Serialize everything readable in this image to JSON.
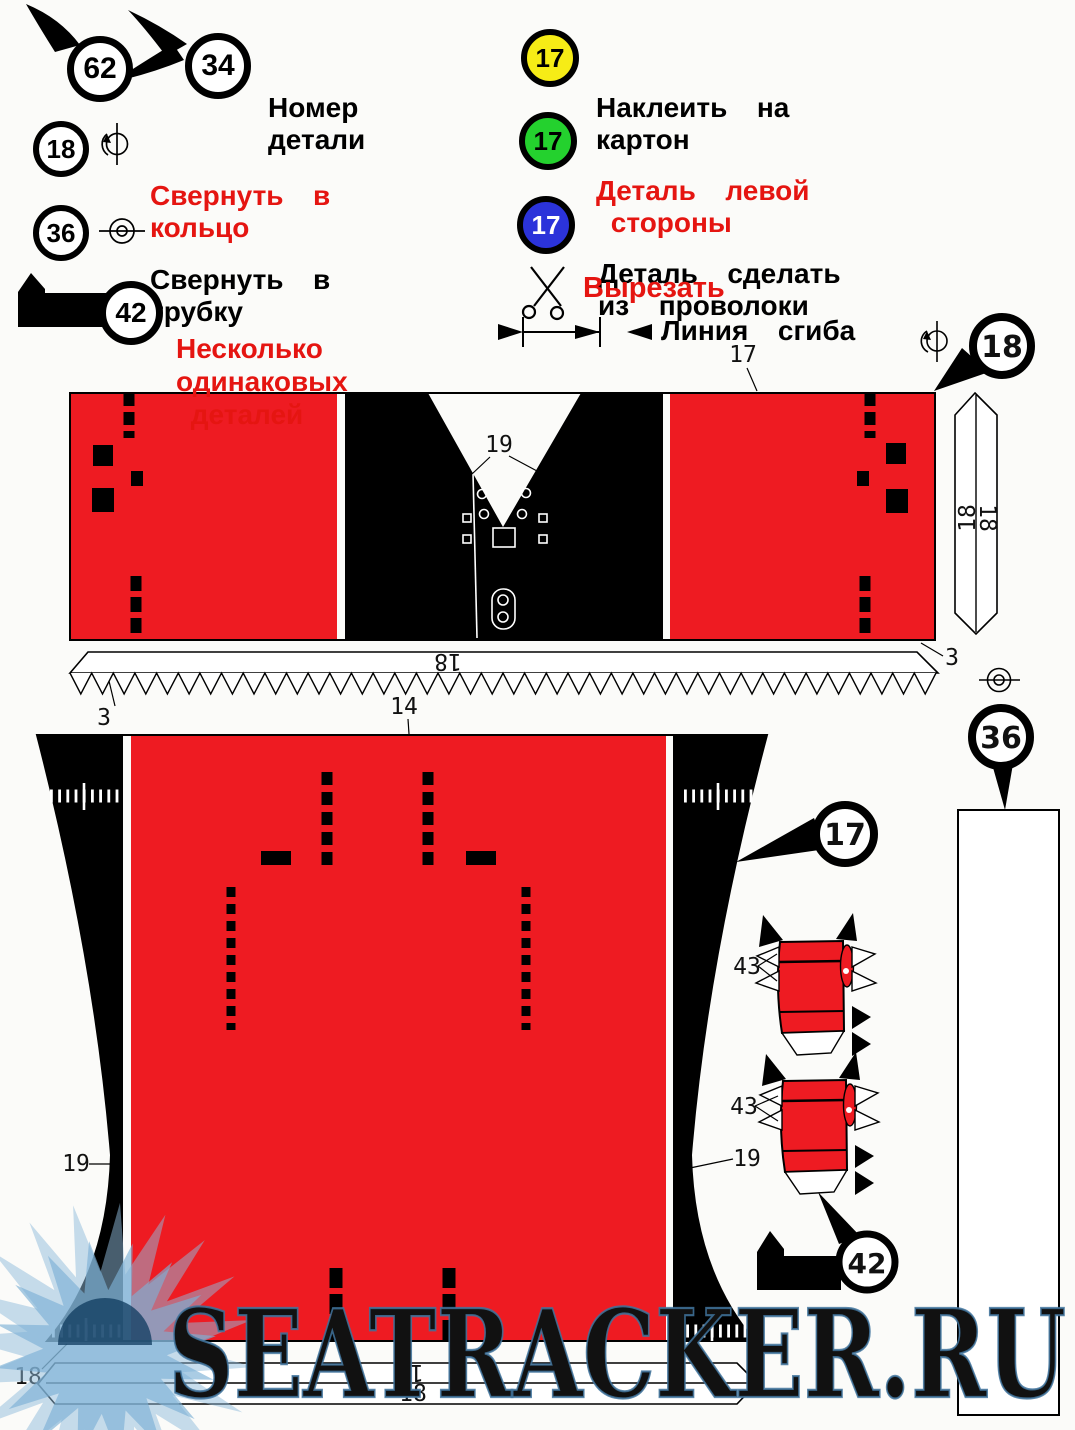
{
  "colors": {
    "part_red": "#ee1b22",
    "badge_yellow": "#f6ec16",
    "badge_green": "#24d12e",
    "badge_blue": "#2b33da",
    "legend_red_text": "#e51511",
    "watermark_blue": "#7db1d6"
  },
  "legend": {
    "part_number": {
      "badge_left": "62",
      "badge_right": "34",
      "line1": "Номер",
      "line2": "детали"
    },
    "roll_into_ring": {
      "badge": "18",
      "line1": "Свернуть  в",
      "line2": "кольцо"
    },
    "roll_into_tube": {
      "badge": "36",
      "line1": "Свернуть  в",
      "line2": "трубку"
    },
    "multiple_identical": {
      "badge": "42",
      "line1": "Несколько",
      "line2": "одинаковых",
      "line3": " деталей"
    },
    "glue_to_cardboard": {
      "badge": "17",
      "line1": "Наклеить  на",
      "line2": "картон"
    },
    "left_side_part": {
      "badge": "17",
      "line1": "Деталь  левой",
      "line2": " стороны"
    },
    "wire_part": {
      "badge": "17",
      "line1": "Деталь  сделать",
      "line2": "из  проволоки"
    },
    "cut_out_label": "Вырезать",
    "fold_line_label": "Линия  сгиба"
  },
  "drawing": {
    "top17": "17",
    "v19": "19",
    "left3": "3",
    "right3": "3",
    "strip18h": "18",
    "badge18": "18",
    "strip18v_a": "18",
    "strip18v_b": "18",
    "part14": "14",
    "badge36": "36",
    "badge17": "17",
    "left19": "19",
    "right19": "19",
    "tab43a": "43",
    "tab43b": "43",
    "badge42": "42",
    "bottom18": "18",
    "bottom_strip17": "17",
    "bottom_strip18": "18"
  },
  "watermark": {
    "site": "SEATRACKER.RU"
  }
}
